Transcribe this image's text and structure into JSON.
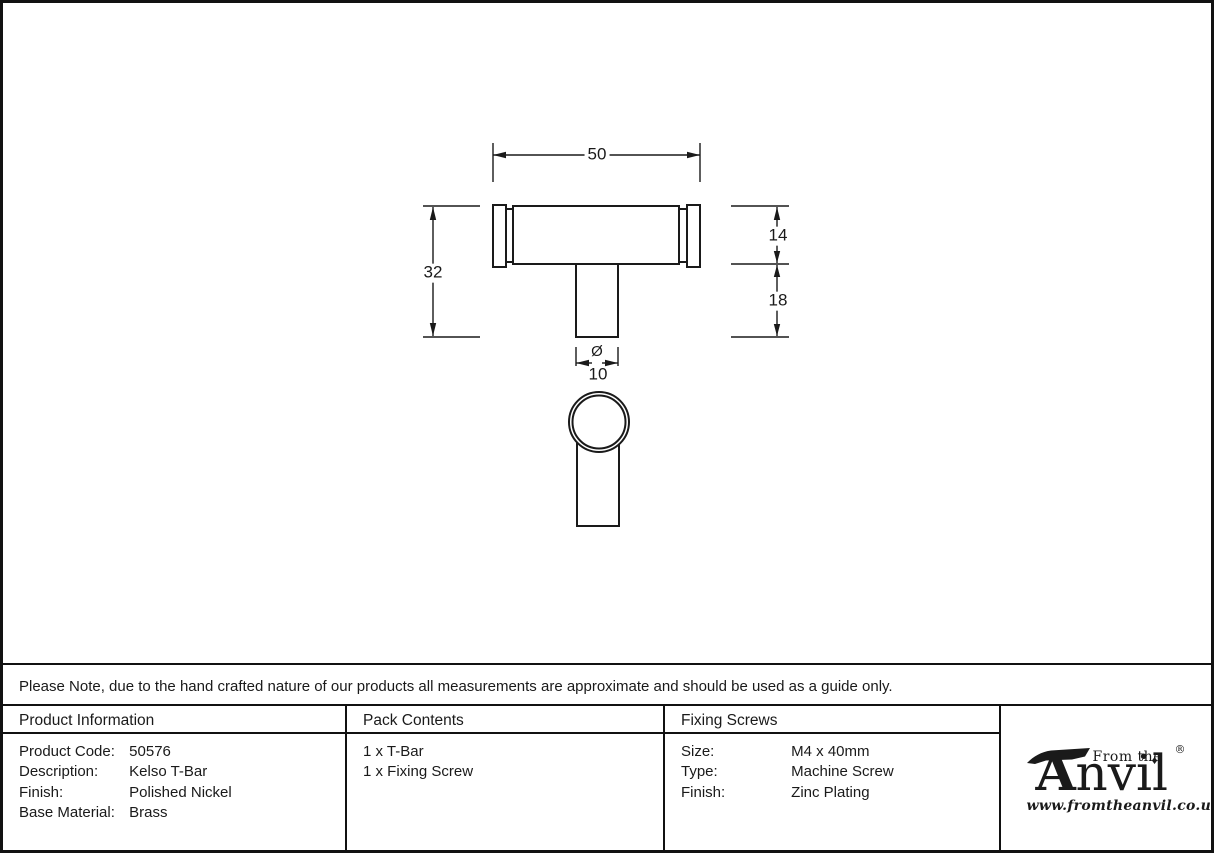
{
  "drawing": {
    "dimensions": {
      "width": "50",
      "height": "32",
      "bar_thickness": "14",
      "stem_length": "18",
      "diameter_symbol": "Ø",
      "diameter_value": "10"
    }
  },
  "note": {
    "text": "Please Note, due to the hand crafted nature of our products all measurements are approximate and should be used as a guide only."
  },
  "table": {
    "product_information": {
      "header": "Product Information",
      "rows": [
        {
          "label": "Product Code:",
          "value": "50576"
        },
        {
          "label": "Description:",
          "value": "Kelso T-Bar"
        },
        {
          "label": "Finish:",
          "value": "Polished Nickel"
        },
        {
          "label": "Base Material:",
          "value": "Brass"
        }
      ]
    },
    "pack_contents": {
      "header": "Pack Contents",
      "items": [
        "1 x T-Bar",
        "1 x Fixing Screw"
      ]
    },
    "fixing_screws": {
      "header": "Fixing Screws",
      "rows": [
        {
          "label": "Size:",
          "value": "M4 x 40mm"
        },
        {
          "label": "Type:",
          "value": "Machine Screw"
        },
        {
          "label": "Finish:",
          "value": "Zinc Plating"
        }
      ]
    }
  },
  "logo": {
    "name_initial": "A",
    "name_rest": "nvil",
    "prefix": "From the",
    "diamond": "♦",
    "registered": "®",
    "website": "www.fromtheanvil.co.uk"
  },
  "colors": {
    "line": "#1a1a1a",
    "background": "#ffffff"
  }
}
